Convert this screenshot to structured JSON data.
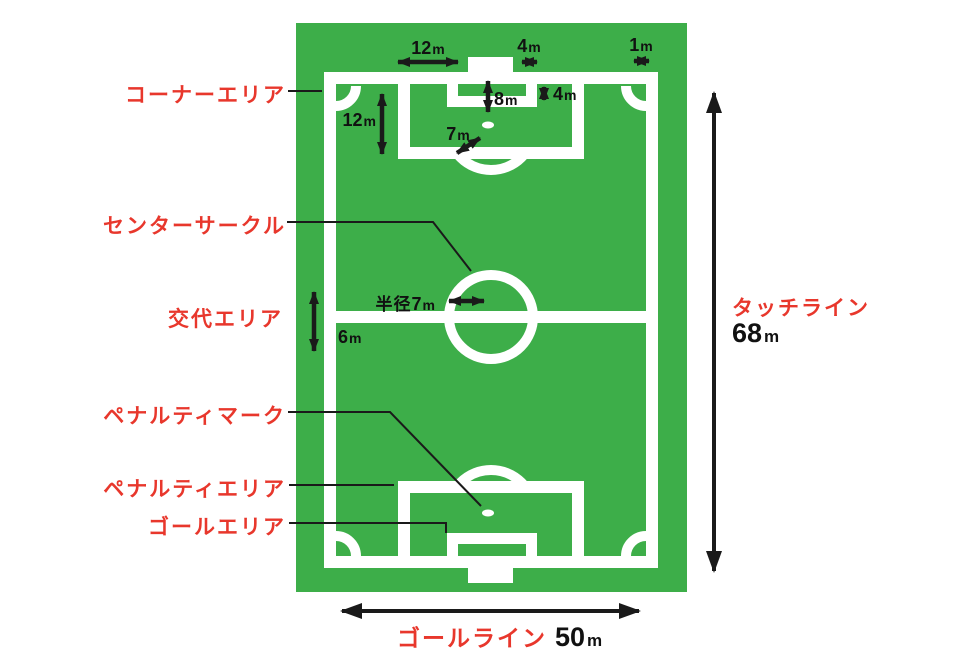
{
  "diagram_type": "soccer-field-dimensions",
  "colors": {
    "field_green": "#3dae49",
    "line_white": "#ffffff",
    "label_red": "#e8372c",
    "arrow_black": "#1a1a1a"
  },
  "labels": {
    "corner_area": "コーナーエリア",
    "center_circle": "センターサークル",
    "substitution_area": "交代エリア",
    "penalty_mark": "ペナルティマーク",
    "penalty_area": "ペナルティエリア",
    "goal_area": "ゴールエリア",
    "touch_line": {
      "name": "タッチライン",
      "value": "68",
      "unit": "m"
    },
    "goal_line": {
      "name": "ゴールライン",
      "value": "50",
      "unit": "m"
    }
  },
  "measurements": {
    "penalty_area_half_width": {
      "value": "12",
      "unit": "m"
    },
    "goal_width": {
      "value": "4",
      "unit": "m"
    },
    "corner_arc_radius": {
      "value": "1",
      "unit": "m"
    },
    "penalty_area_depth": {
      "value": "12",
      "unit": "m"
    },
    "penalty_mark_distance": {
      "value": "8",
      "unit": "m"
    },
    "goal_area_depth": {
      "value": "4",
      "unit": "m"
    },
    "penalty_arc_radius": {
      "value": "7",
      "unit": "m"
    },
    "substitution_zone": {
      "value": "6",
      "unit": "m"
    },
    "center_circle_radius": {
      "prefix": "半径",
      "value": "7",
      "unit": "m"
    }
  }
}
